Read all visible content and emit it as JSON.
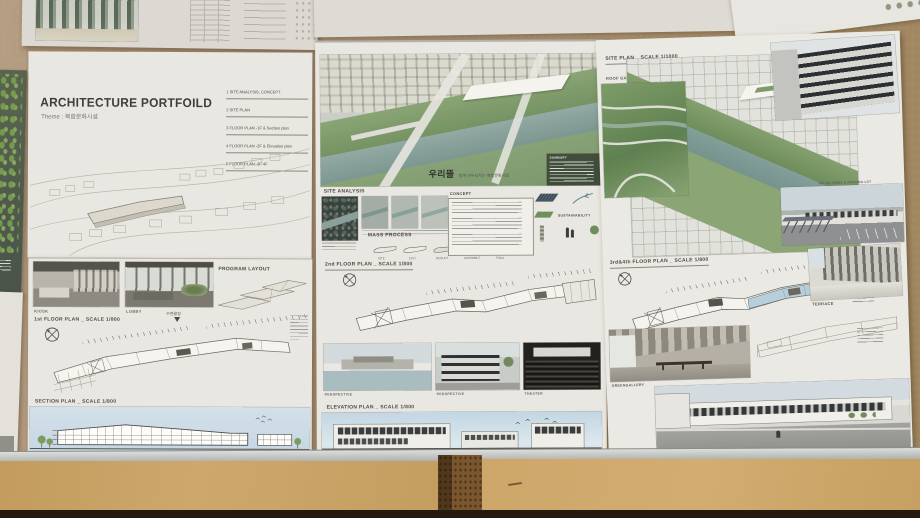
{
  "colors": {
    "wall": "#ab9174",
    "paper": "#e9e7e1",
    "table_wood": "#c9a468",
    "rail_metal": "#b9bbb9",
    "river": "#849e97",
    "park_green": "#83a06e",
    "sky_blue": "#c5d8e3"
  },
  "left_board": {
    "title": "ARCHITECTURE PORTFOILD",
    "theme": "Theme : 복합문화시설",
    "index": [
      "1 SITE ANALYSIS, CONCEPT",
      "2 SITE PLAN",
      "3 FLOOR PLAN -1F & Section plan",
      "4 FLOOR PLAN -2F & Elevation plan",
      "5 FLOOR PLAN -3F 4F"
    ],
    "kiosk_label": "KIOSK",
    "lobby_label": "LOBBY",
    "program_layout_label": "PROGRAM LAYOUT",
    "floor1_title": "1st FLOOR PLAN _ SCALE 1/800",
    "plaza_label": "수변광장",
    "section_title": "SECTION PLAN _ SCALE 1/800"
  },
  "middle_board": {
    "hero_title": "우리뜰",
    "hero_subtitle": "함께 어우러지는 복합문화시설",
    "summary_label": "SUMMARY",
    "site_analysis_label": "SITE ANALYSIS",
    "concept_label": "CONCEPT",
    "mass_process_label": "MASS PROCESS",
    "mass_steps": [
      "SITE",
      "ECO",
      "DEDUCT",
      "ASSEMBLE",
      "FINAL"
    ],
    "sustainability_label": "SUSTAINABILITY",
    "floor2_title": "2nd FLOOR PLAN _ SCALE 1/800",
    "photo_labels": [
      "PERSPECTIVE",
      "PERSPECTIVE",
      "THEATER"
    ],
    "elevation_title": "ELEVATION PLAN _ SCALE 1/800"
  },
  "right_board": {
    "site_plan_title": "SITE PLAN _ SCALE 1/1000",
    "roof_garden_label": "ROOF GARDEN",
    "parking_label": "SOLAR PANEL & PARKING LOT",
    "floor34_title": "3rd&4th FLOOR PLAN _ SCALE 1/800",
    "terrace_label": "TERRACE",
    "gallery_label": "GREENGALLERY"
  },
  "icons": {
    "north_arrow": "compass-circle-x"
  }
}
